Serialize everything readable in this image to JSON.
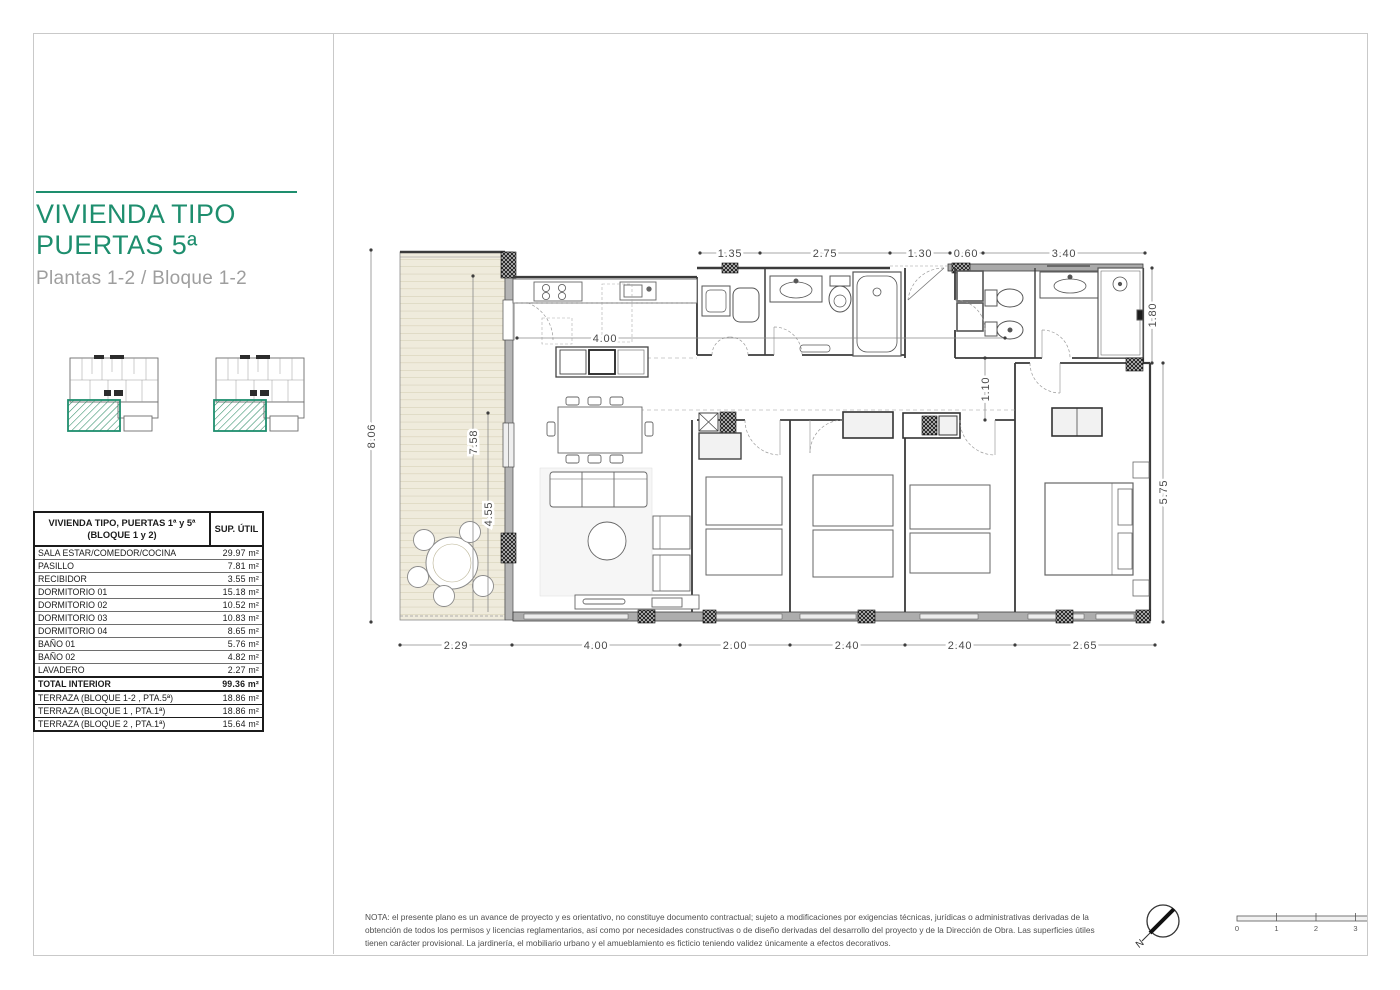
{
  "sidebar": {
    "title_line1": "VIVIENDA TIPO",
    "title_line2": "PUERTAS 5ª",
    "subtitle": "Plantas 1-2 / Bloque 1-2",
    "table": {
      "header": {
        "name_line1": "VIVIENDA TIPO, PUERTAS 1ª y 5ª",
        "name_line2": "(BLOQUE 1 y 2)",
        "sup": "SUP. ÚTIL"
      },
      "rows": [
        {
          "label": "SALA ESTAR/COMEDOR/COCINA",
          "value": "29.97 m²"
        },
        {
          "label": "PASILLO",
          "value": "7.81 m²"
        },
        {
          "label": "RECIBIDOR",
          "value": "3.55 m²"
        },
        {
          "label": "DORMITORIO 01",
          "value": "15.18 m²"
        },
        {
          "label": "DORMITORIO 02",
          "value": "10.52 m²"
        },
        {
          "label": "DORMITORIO 03",
          "value": "10.83 m²"
        },
        {
          "label": "DORMITORIO 04",
          "value": "8.65 m²"
        },
        {
          "label": "BAÑO 01",
          "value": "5.76 m²"
        },
        {
          "label": "BAÑO 02",
          "value": "4.82 m²"
        },
        {
          "label": "LAVADERO",
          "value": "2.27 m²"
        }
      ],
      "total": {
        "label": "TOTAL INTERIOR",
        "value": "99.36 m²"
      },
      "terrace_rows": [
        {
          "label": "TERRAZA (BLOQUE 1-2 , PTA.5ª)",
          "value": "18.86 m²"
        },
        {
          "label": "TERRAZA (BLOQUE 1 , PTA.1ª)",
          "value": "18.86 m²"
        },
        {
          "label": "TERRAZA (BLOQUE 2 , PTA.1ª)",
          "value": "15.64 m²"
        }
      ]
    }
  },
  "plan": {
    "dims_top": [
      "1.35",
      "2.75",
      "1.30",
      "0.60",
      "3.40"
    ],
    "dims_bottom": [
      "2.29",
      "4.00",
      "2.00",
      "2.40",
      "2.40",
      "2.65"
    ],
    "dim_left": "8.06",
    "dim_right_upper": "1.80",
    "dim_right_lower": "5.75",
    "dim_living": "4.00",
    "dim_terrace_a": "7.58",
    "dim_terrace_b": "4.55",
    "dim_hall": "1.10"
  },
  "footer": {
    "note": "NOTA: el presente plano es un avance de proyecto y es orientativo, no constituye documento contractual; sujeto a modificaciones por exigencias técnicas, jurídicas o administrativas derivadas de la obtención de todos los permisos y licencias reglamentarios, así como por necesidades constructivas o de diseño derivadas del desarrollo del proyecto y de la Dirección de Obra. Las superficies útiles tienen carácter provisional. La jardinería, el mobiliario urbano y el amueblamiento es ficticio teniendo validez únicamente a efectos decorativos.",
    "compass_label": "N",
    "scalebar_ticks": [
      "0",
      "1",
      "2",
      "3",
      "4"
    ]
  }
}
